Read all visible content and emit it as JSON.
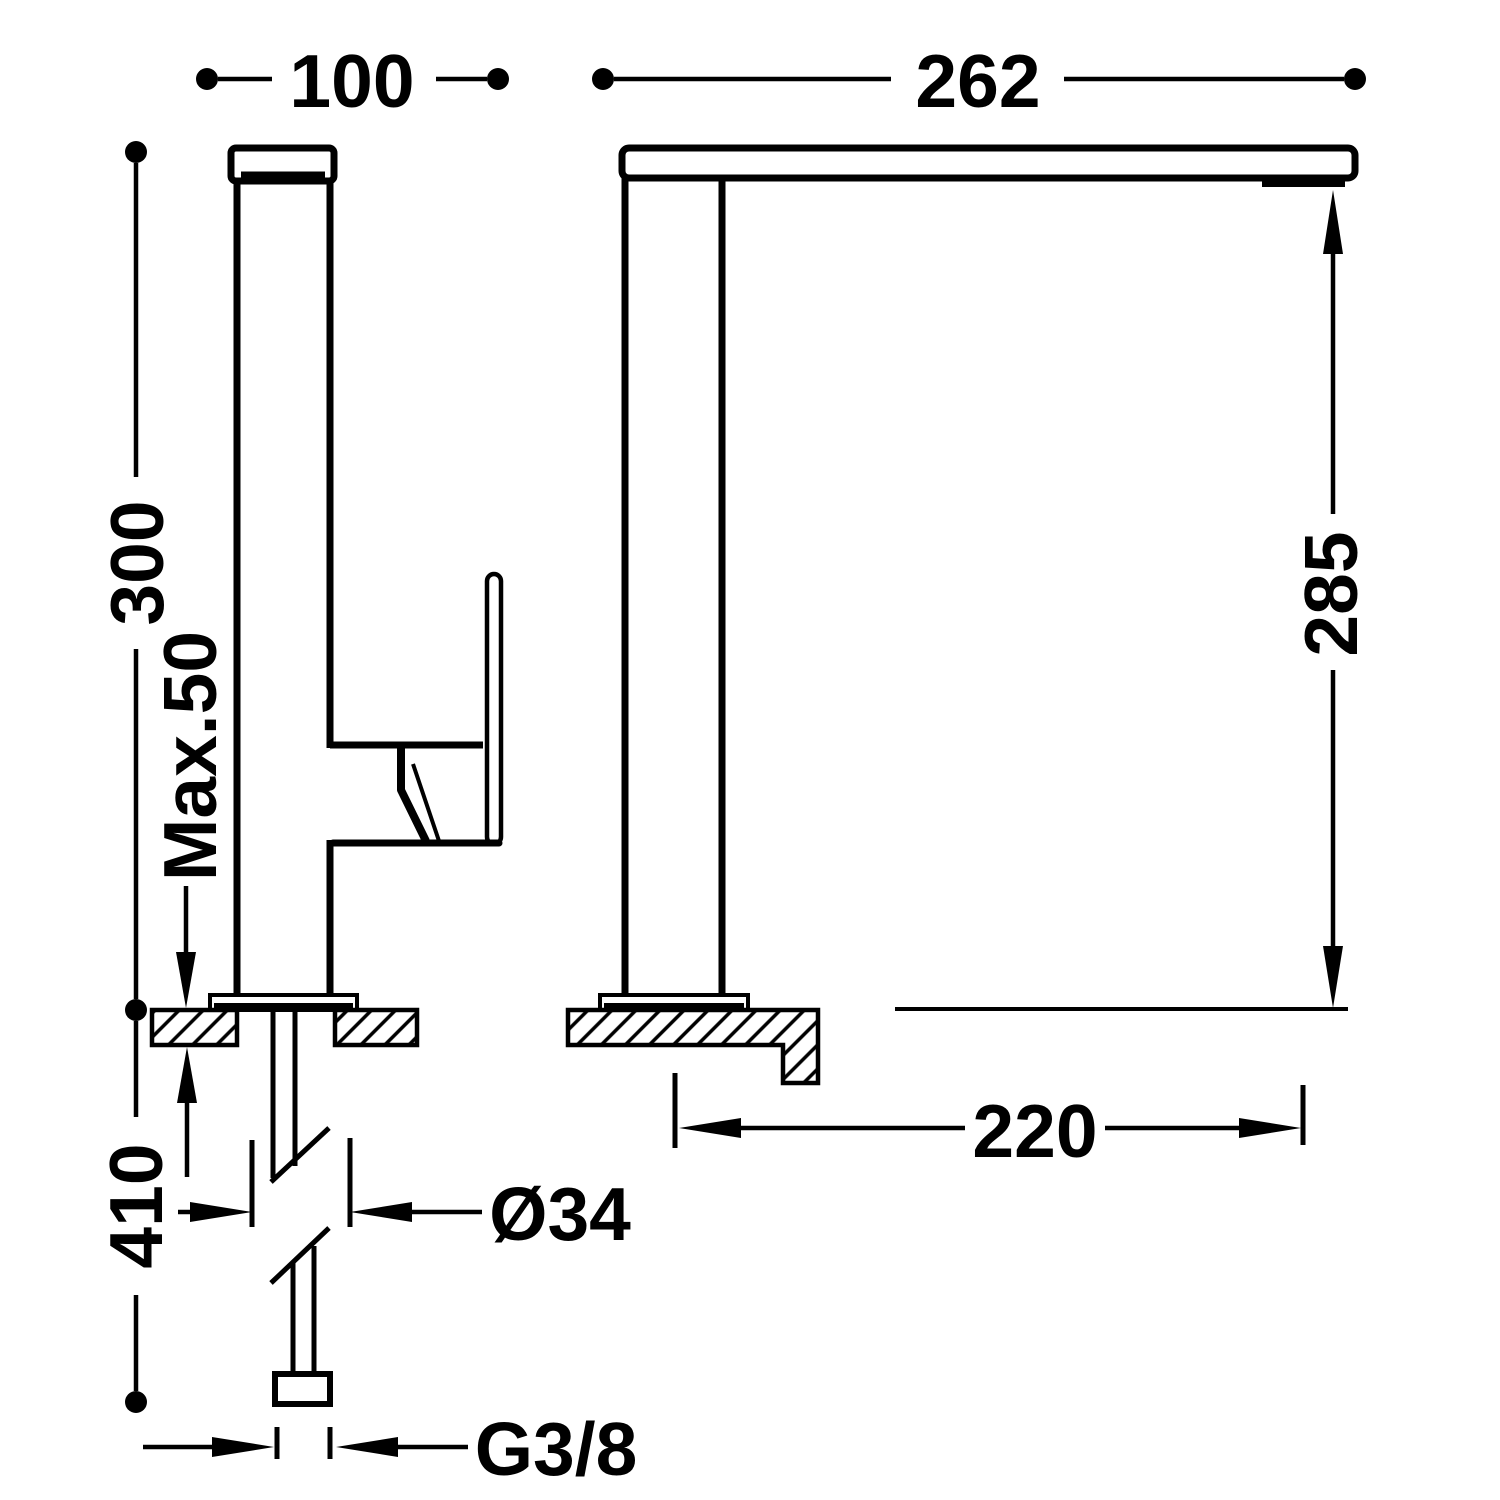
{
  "drawing": {
    "type": "technical-dimension-drawing",
    "subject": "single-lever kitchen mixer tap, side and front elevations with installation dimensions",
    "background_color": "#ffffff",
    "line_color": "#000000",
    "dimensions": {
      "front_width": "100",
      "spout_length": "262",
      "body_height": "300",
      "max_deck_thickness": "Max.50",
      "outlet_height": "285",
      "spout_reach": "220",
      "hose_drop": "410",
      "body_diameter": "Ø34",
      "thread": "G3/8"
    }
  }
}
